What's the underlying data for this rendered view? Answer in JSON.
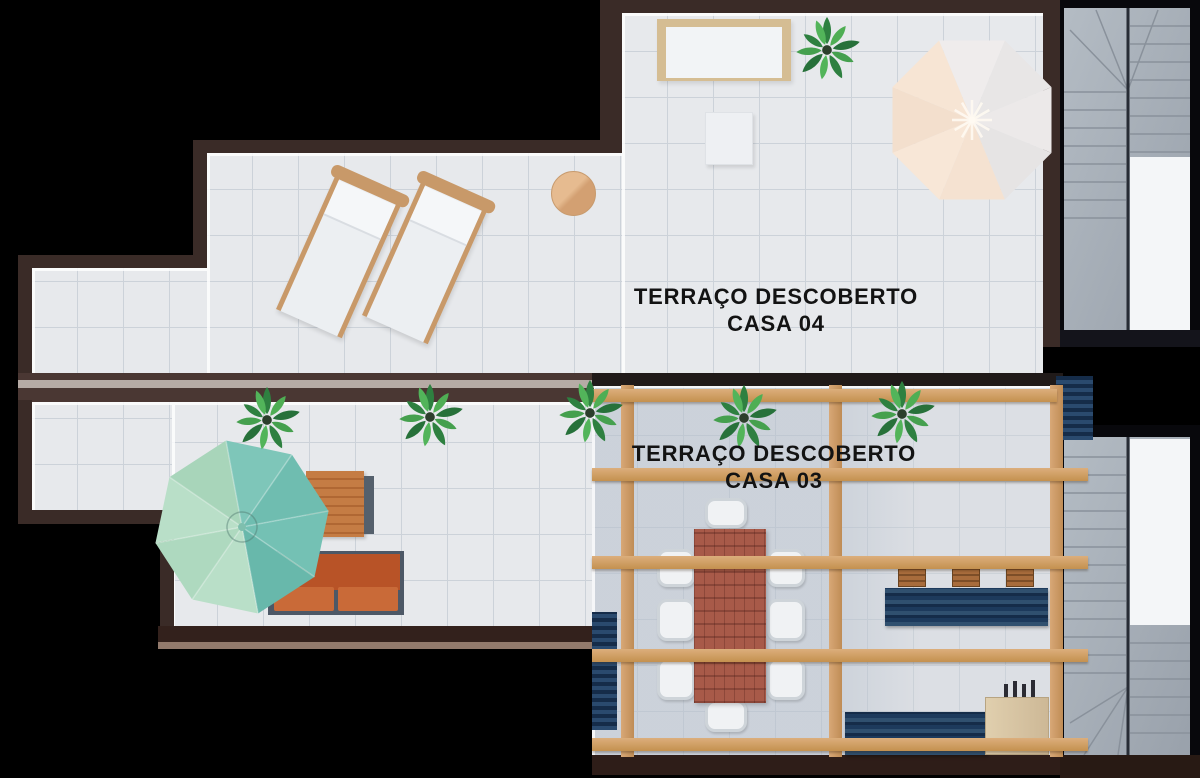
{
  "labels": {
    "casa04": {
      "line1": "TERRAÇO DESCOBERTO",
      "line2": "CASA 04"
    },
    "casa03": {
      "line1": "TERRAÇO DESCOBERTO",
      "line2": "CASA 03"
    }
  },
  "palette": {
    "background": "#000000",
    "wall_dark": "#3a2b27",
    "wall_mid": "#4a3733",
    "wall_stripe": "#c9c0ba",
    "wall_bottom": "#33211c",
    "floor": "#e7e9ec",
    "floor_shaded": "#dcdfe4",
    "floor_line": "#ccd2d9",
    "pergola_wood": "#d2a06f",
    "plant_dark": "#2e8040",
    "plant_light": "#4fae54",
    "umbrella_teal": "#72bfb2",
    "umbrella_mint": "#b4dcc3",
    "umbrella_peach": "#f6e3d2",
    "umbrella_gray": "#e8e6e6",
    "lounger_wood": "#c89969",
    "fabric_white": "#eceff2",
    "wicker": "#d5bd93",
    "sofa_orange": "#c05b30",
    "sofa_frame": "#4d5866",
    "table_wood": "#c1763f",
    "dining_wood": "#a85a49",
    "counter_navy": "#23395b",
    "cabinet_beige": "#d9c7a6",
    "stairs_granite": "#a9b1ba",
    "stairs_white": "#f4f6f8",
    "label": "#131313"
  }
}
